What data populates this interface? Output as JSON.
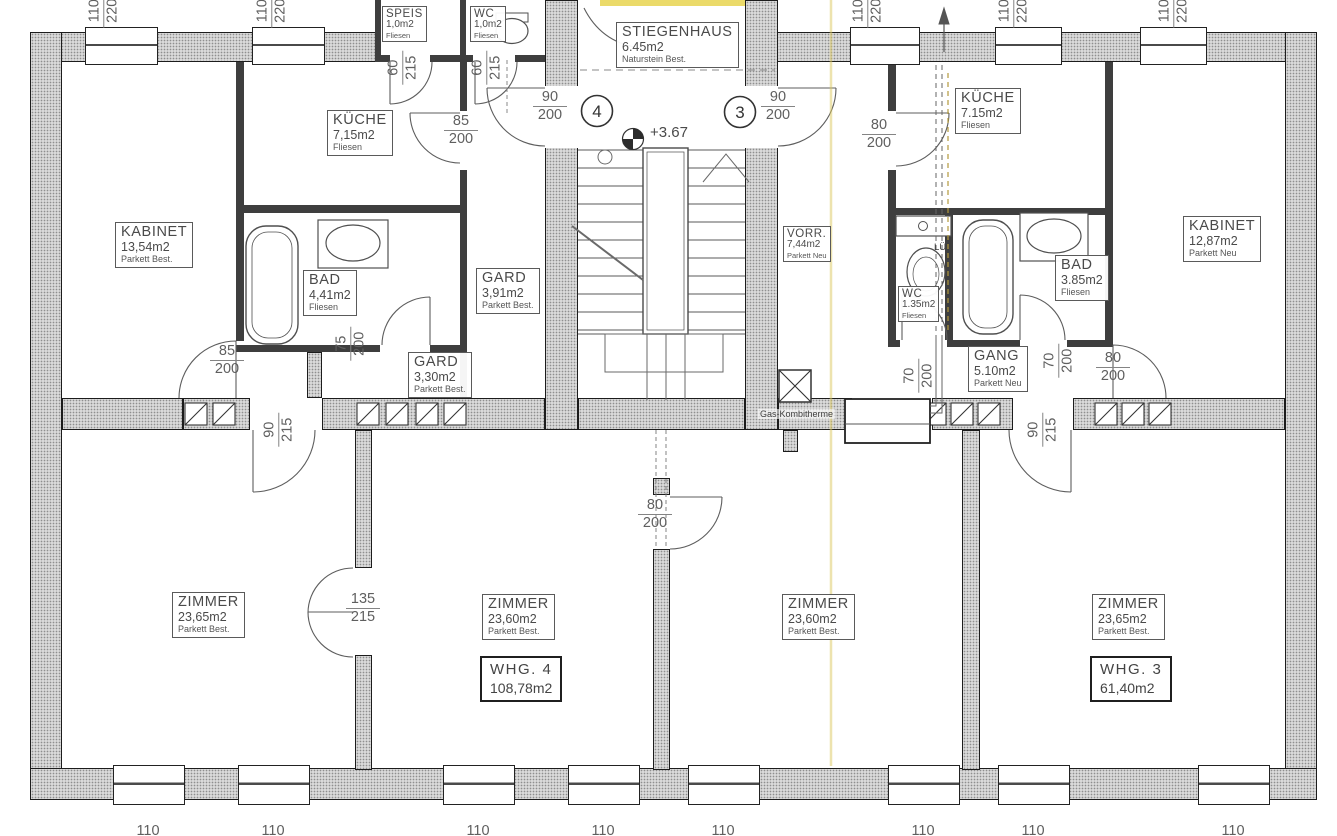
{
  "rooms": {
    "speis": {
      "name": "SPEIS",
      "area": "1,0m2",
      "floor": "Fliesen"
    },
    "wc_left": {
      "name": "WC",
      "area": "1,0m2",
      "floor": "Fliesen"
    },
    "stiegenhaus": {
      "name": "STIEGENHAUS",
      "area": "6.45m2",
      "floor": "Naturstein Best."
    },
    "kueche_left": {
      "name": "KÜCHE",
      "area": "7,15m2",
      "floor": "Fliesen"
    },
    "kabinet_left": {
      "name": "KABINET",
      "area": "13,54m2",
      "floor": "Parkett Best."
    },
    "bad_left": {
      "name": "BAD",
      "area": "4,41m2",
      "floor": "Fliesen"
    },
    "gard_a": {
      "name": "GARD",
      "area": "3,91m2",
      "floor": "Parkett Best."
    },
    "gard_b": {
      "name": "GARD",
      "area": "3,30m2",
      "floor": "Parkett Best."
    },
    "vorr": {
      "name": "VORR.",
      "area": "7,44m2",
      "floor": "Parkett Neu"
    },
    "kueche_right": {
      "name": "KÜCHE",
      "area": "7.15m2",
      "floor": "Fliesen"
    },
    "wc_right": {
      "name": "WC",
      "area": "1.35m2",
      "floor": "Fliesen"
    },
    "bad_right": {
      "name": "BAD",
      "area": "3.85m2",
      "floor": "Fliesen"
    },
    "gang": {
      "name": "GANG",
      "area": "5.10m2",
      "floor": "Parkett Neu"
    },
    "kabinet_right": {
      "name": "KABINET",
      "area": "12,87m2",
      "floor": "Parkett Neu"
    },
    "zimmer_sw": {
      "name": "ZIMMER",
      "area": "23,65m2",
      "floor": "Parkett Best."
    },
    "zimmer_s2": {
      "name": "ZIMMER",
      "area": "23,60m2",
      "floor": "Parkett Best."
    },
    "zimmer_s3": {
      "name": "ZIMMER",
      "area": "23,60m2",
      "floor": "Parkett Best."
    },
    "zimmer_se": {
      "name": "ZIMMER",
      "area": "23,65m2",
      "floor": "Parkett Best."
    }
  },
  "units": {
    "whg4": {
      "label": "WHG.  4",
      "area": "108,78m2"
    },
    "whg3": {
      "label": "WHG.  3",
      "area": "61,40m2"
    }
  },
  "dims": {
    "d60_215": {
      "w": "60",
      "h": "215"
    },
    "d85_200": {
      "w": "85",
      "h": "200"
    },
    "d90_200": {
      "w": "90",
      "h": "200"
    },
    "d80_200": {
      "w": "80",
      "h": "200"
    },
    "d75_200": {
      "w": "75",
      "h": "200"
    },
    "d70_200": {
      "w": "70",
      "h": "200"
    },
    "d90_215": {
      "w": "90",
      "h": "215"
    },
    "d135_215": {
      "w": "135",
      "h": "215"
    },
    "d110_220": {
      "w": "110",
      "h": "220"
    }
  },
  "annotations": {
    "level": "+3.67",
    "stair_door_4": "4",
    "stair_door_3": "3",
    "therme": "Gas-Kombitherme",
    "vent": "LÜ"
  }
}
